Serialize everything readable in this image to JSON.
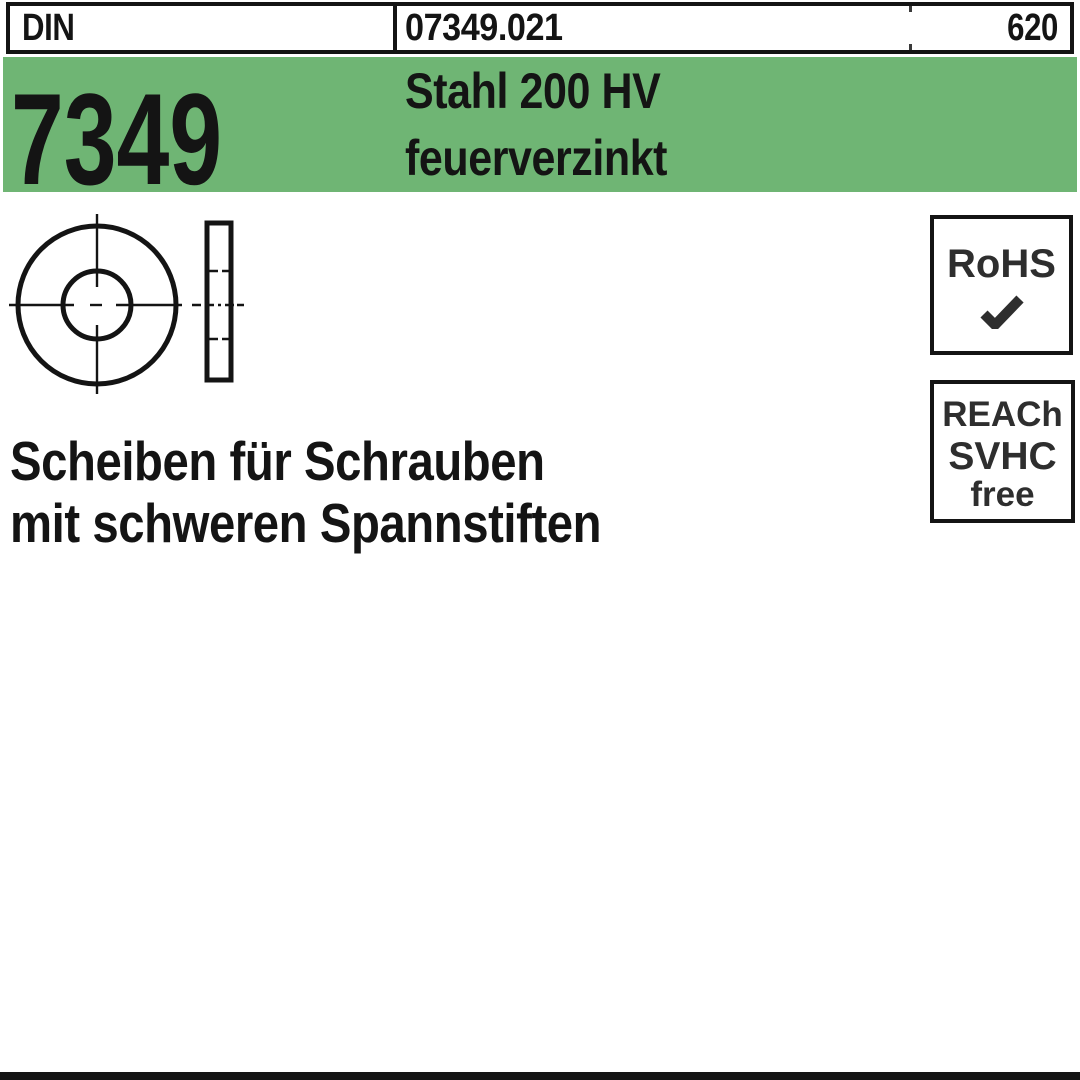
{
  "colors": {
    "banner_green": "#6fb574",
    "ink": "#141414",
    "badge_ink": "#2e2e2e"
  },
  "header": {
    "din_label": "DIN",
    "article_number": "07349.021",
    "catalog_page": "620"
  },
  "banner": {
    "din_number": "7349",
    "material": "Stahl 200 HV",
    "coating": "feuerverzinkt"
  },
  "badges": {
    "rohs_label": "RoHS",
    "rohs_check_icon": "checkmark",
    "reach_line1": "REACh",
    "reach_line2": "SVHC",
    "reach_line3": "free"
  },
  "description": {
    "line1": "Scheiben für Schrauben",
    "line2": "mit schweren Spannstiften"
  }
}
